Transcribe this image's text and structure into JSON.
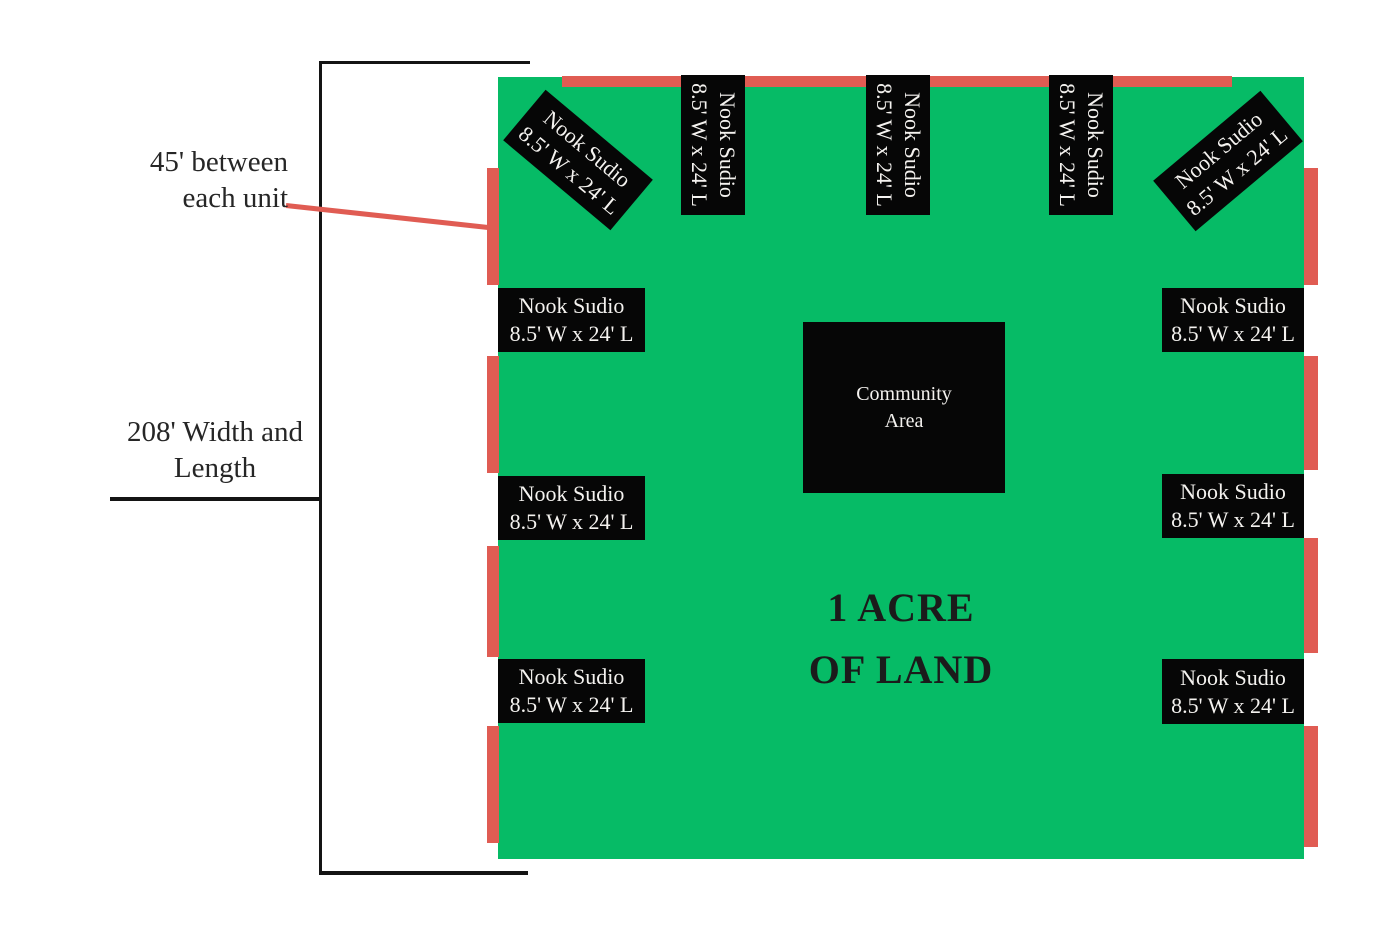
{
  "title": {
    "line1": "1 ACRE",
    "line2": "OF LAND"
  },
  "community_area": {
    "line1": "Community",
    "line2": "Area"
  },
  "unit": {
    "name": "Nook Sudio",
    "dimensions": "8.5' W x 24' L"
  },
  "annotations": {
    "unit_spacing": {
      "line1": "45' between",
      "line2": "each unit"
    },
    "land_dimensions": {
      "line1": "208' Width and",
      "line2": "Length"
    }
  },
  "colors": {
    "land_green": "#06BB66",
    "marker_red": "#E05C53",
    "unit_box_black": "#060606"
  }
}
